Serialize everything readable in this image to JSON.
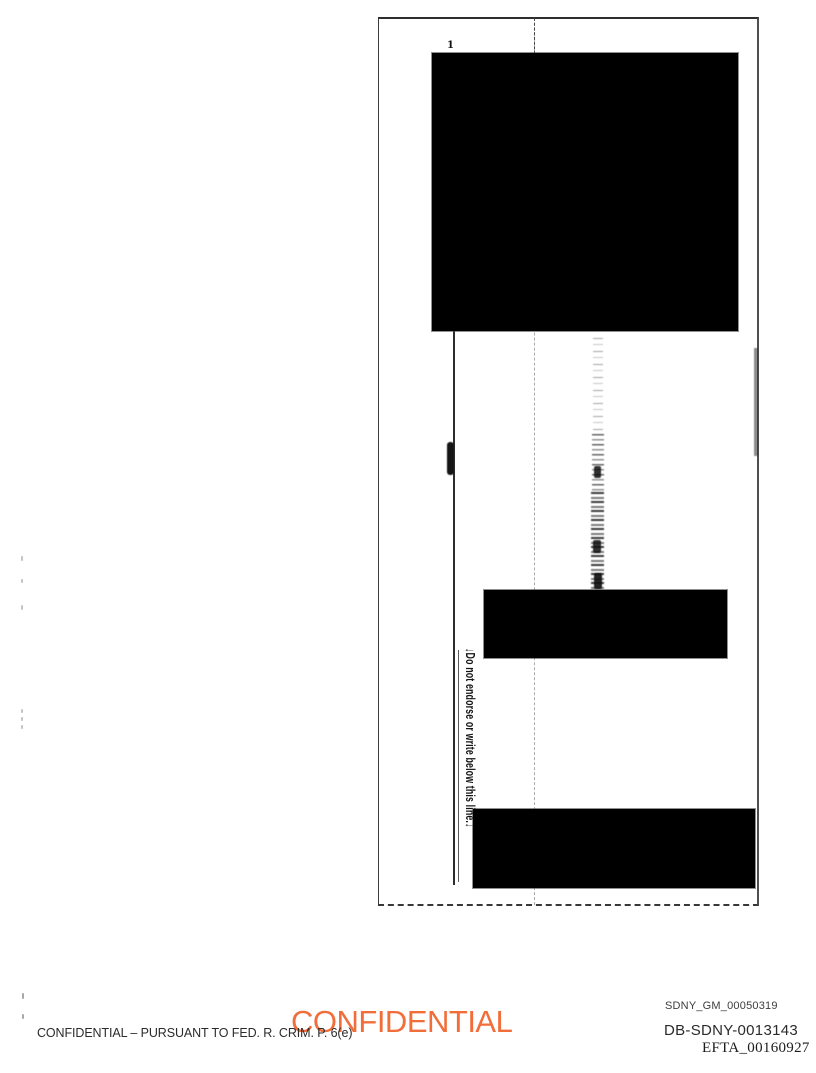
{
  "scan": {
    "tick_label": "1",
    "endorse_warning": "↓Do not endorse or write below this line.↓"
  },
  "footer": {
    "grand_jury_line": "CONFIDENTIAL – PURSUANT TO FED. R. CRIM. P. 6(e)",
    "confidential_stamp": "CONFIDENTIAL",
    "bates": [
      {
        "label": "SDNY_GM_00050319"
      },
      {
        "label": "DB-SDNY-0013143"
      },
      {
        "label": "EFTA_00160927"
      }
    ]
  },
  "colors": {
    "stamp_orange": "#F0591F",
    "redaction_black": "#000000",
    "stamp_style": "color:#F0591F"
  }
}
